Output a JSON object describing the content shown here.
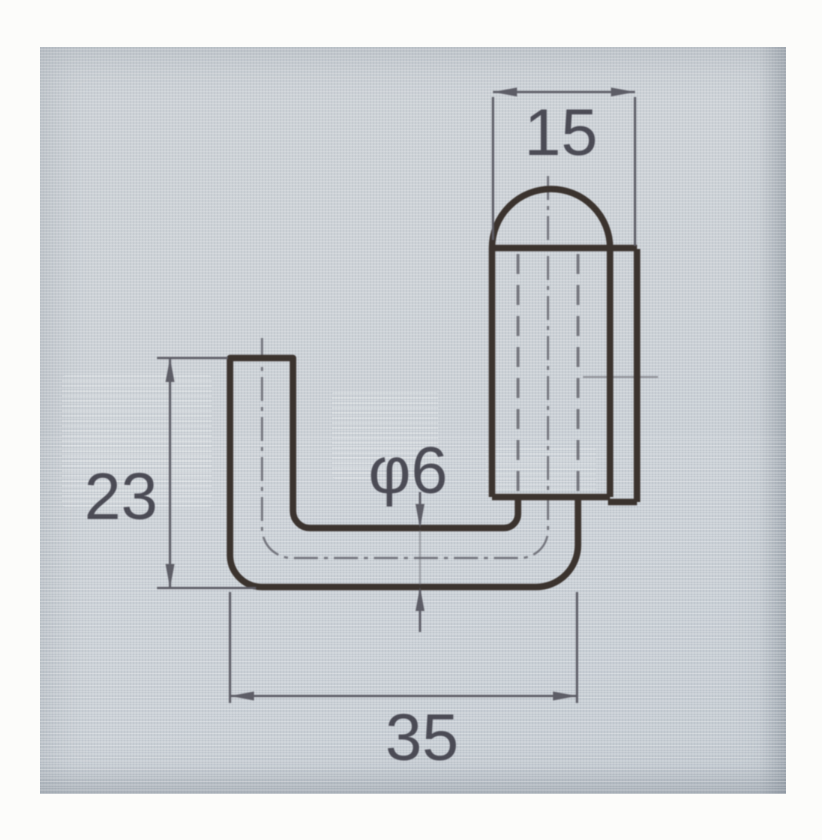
{
  "drawing": {
    "type": "technical-drawing",
    "part": "bent-rod-hook-with-domed-knob",
    "dimensions": {
      "top_width": "15",
      "left_height": "23",
      "rod_diameter": "φ6",
      "bottom_width": "35"
    }
  },
  "style": {
    "thick_line_color": "#3b332e",
    "thin_line_color": "#5d5d66",
    "hidden_line_color": "#5a5a62",
    "text_color": "#4b4b55",
    "screen_bg": "#cdd2d7",
    "page_bg": "#fcfcfa"
  }
}
